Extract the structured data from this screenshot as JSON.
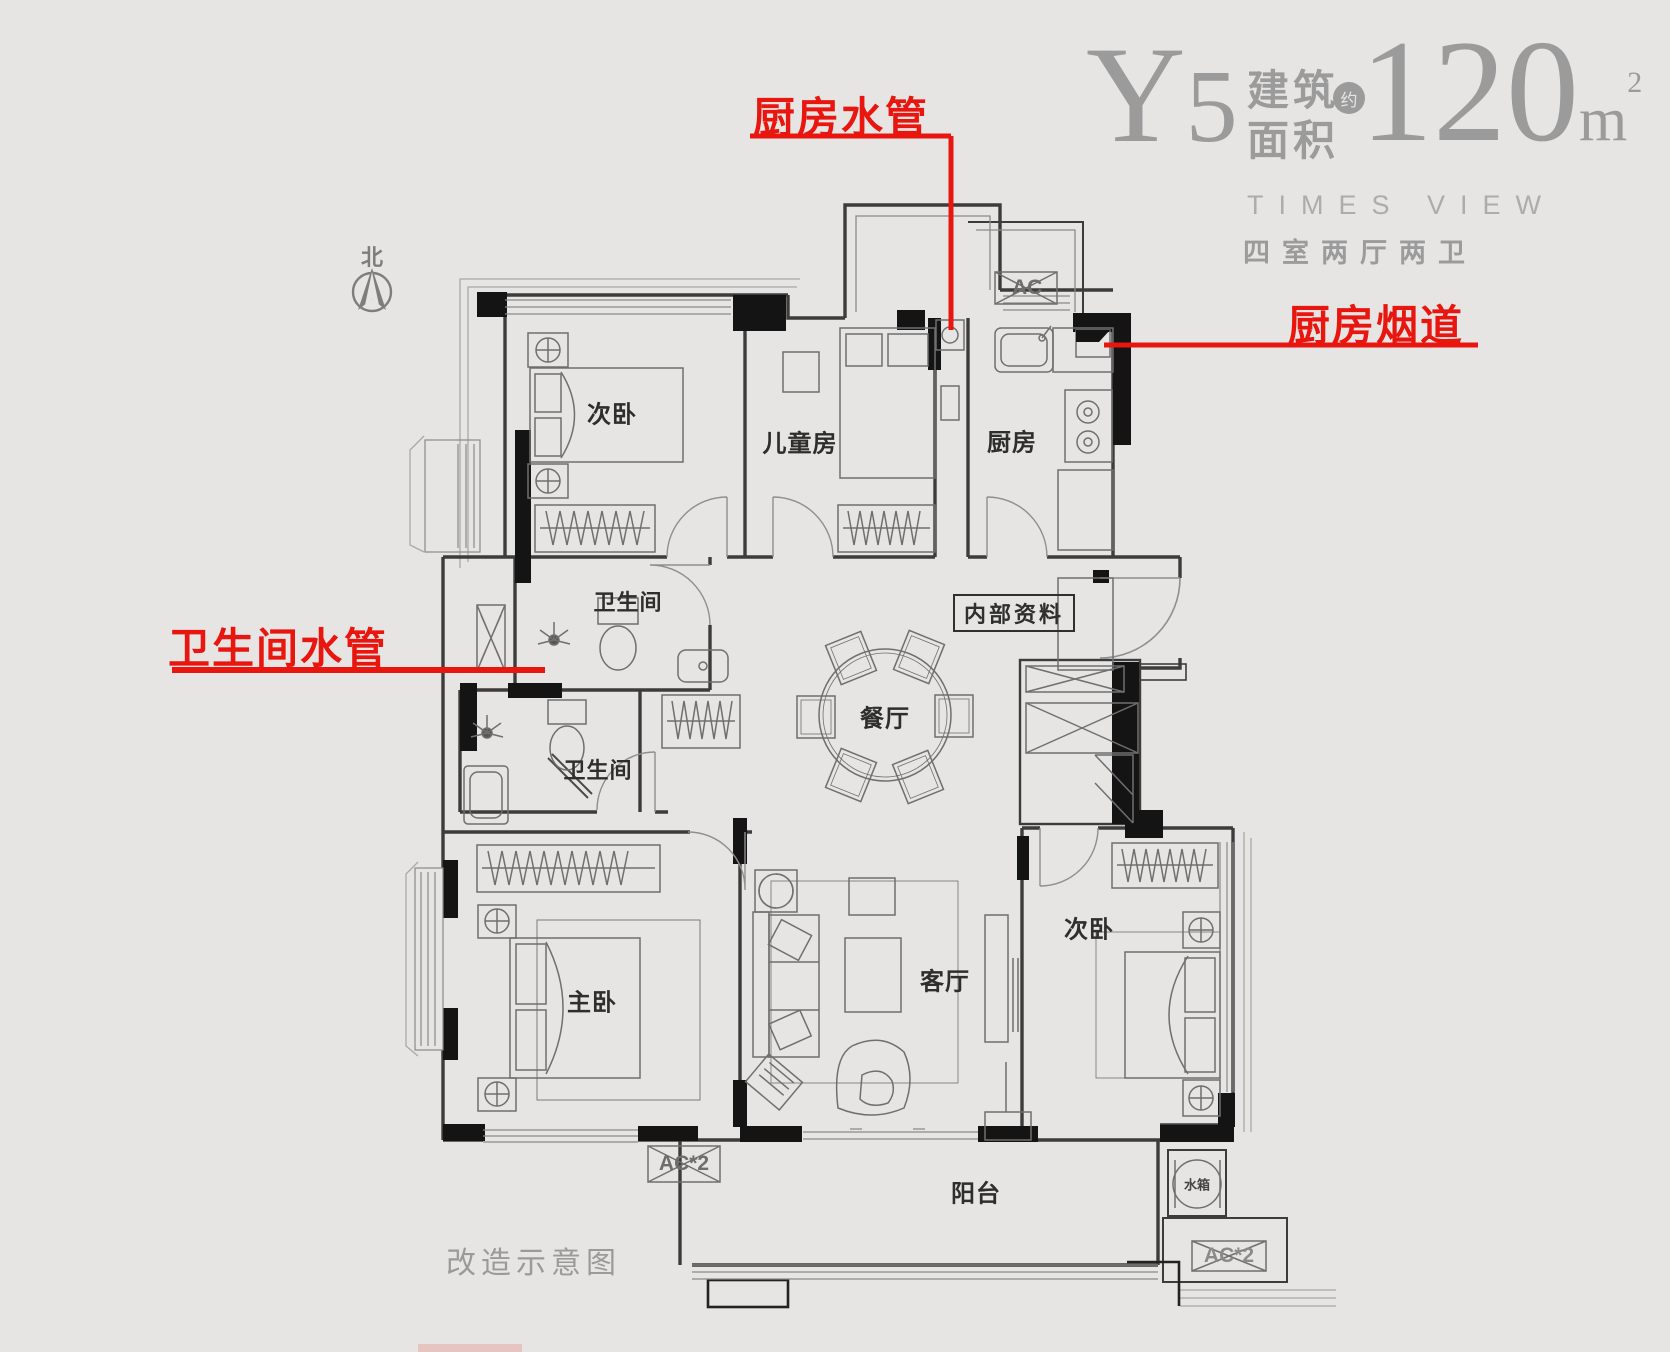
{
  "header": {
    "unit_code_letter": "Y",
    "unit_code_number": "5",
    "area_label_line1": "建筑",
    "area_label_line2": "面积",
    "approx_badge": "约",
    "area_value": "120",
    "area_unit": "m",
    "area_unit_sup": "2",
    "subtitle_en": "TIMES VIEW",
    "subtitle_cn": "四室两厅两卫"
  },
  "compass": {
    "north_label": "北"
  },
  "annotations": {
    "kitchen_water_pipe": "厨房水管",
    "kitchen_flue": "厨房烟道",
    "bathroom_water_pipe": "卫生间水管",
    "accent_color": "#e8160e"
  },
  "rooms": {
    "bedroom_northwest": "次卧",
    "children_room": "儿童房",
    "kitchen": "厨房",
    "bathroom_upper": "卫生间",
    "bathroom_lower": "卫生间",
    "dining_room": "餐厅",
    "master_bedroom": "主卧",
    "living_room": "客厅",
    "bedroom_southeast": "次卧",
    "balcony": "阳台"
  },
  "plan_labels": {
    "internal_material": "内部资料",
    "caption": "改造示意图",
    "ac_unit": "AC",
    "ac_unit_x2_left": "AC*2",
    "ac_unit_x2_right": "AC*2",
    "water_tank": "水箱"
  },
  "colors": {
    "background": "#e6e5e3",
    "title_gray": "#9b9b9b",
    "line_dark": "#2f2f2f",
    "wall_black": "#141414",
    "annotation_red": "#e8160e"
  }
}
